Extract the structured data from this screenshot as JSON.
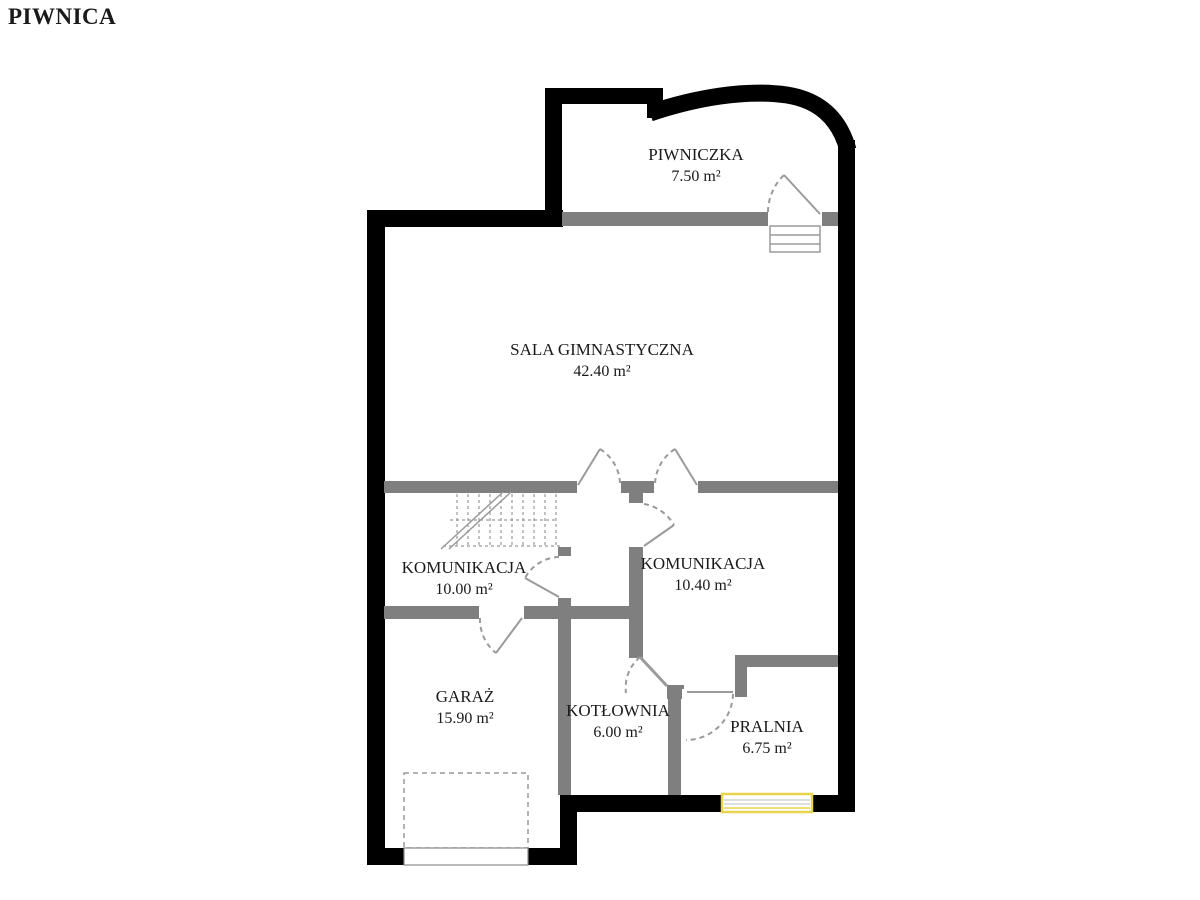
{
  "title": "PIWNICA",
  "rooms": [
    {
      "name": "PIWNICZKA",
      "area": "7.50 m²"
    },
    {
      "name": "SALA GIMNASTYCZNA",
      "area": "42.40 m²"
    },
    {
      "name": "KOMUNIKACJA",
      "area": "10.00 m²"
    },
    {
      "name": "KOMUNIKACJA",
      "area": "10.40 m²"
    },
    {
      "name": "GARAŻ",
      "area": "15.90 m²"
    },
    {
      "name": "KOTŁOWNIA",
      "area": "6.00 m²"
    },
    {
      "name": "PRALNIA",
      "area": "6.75 m²"
    }
  ],
  "colors": {
    "exterior_wall": "#000000",
    "interior_wall": "#7f7f7f",
    "door_lines": "#9a9a9a",
    "window_accent": "#e8d44a",
    "text": "#1a1a1a",
    "background": "#ffffff"
  }
}
